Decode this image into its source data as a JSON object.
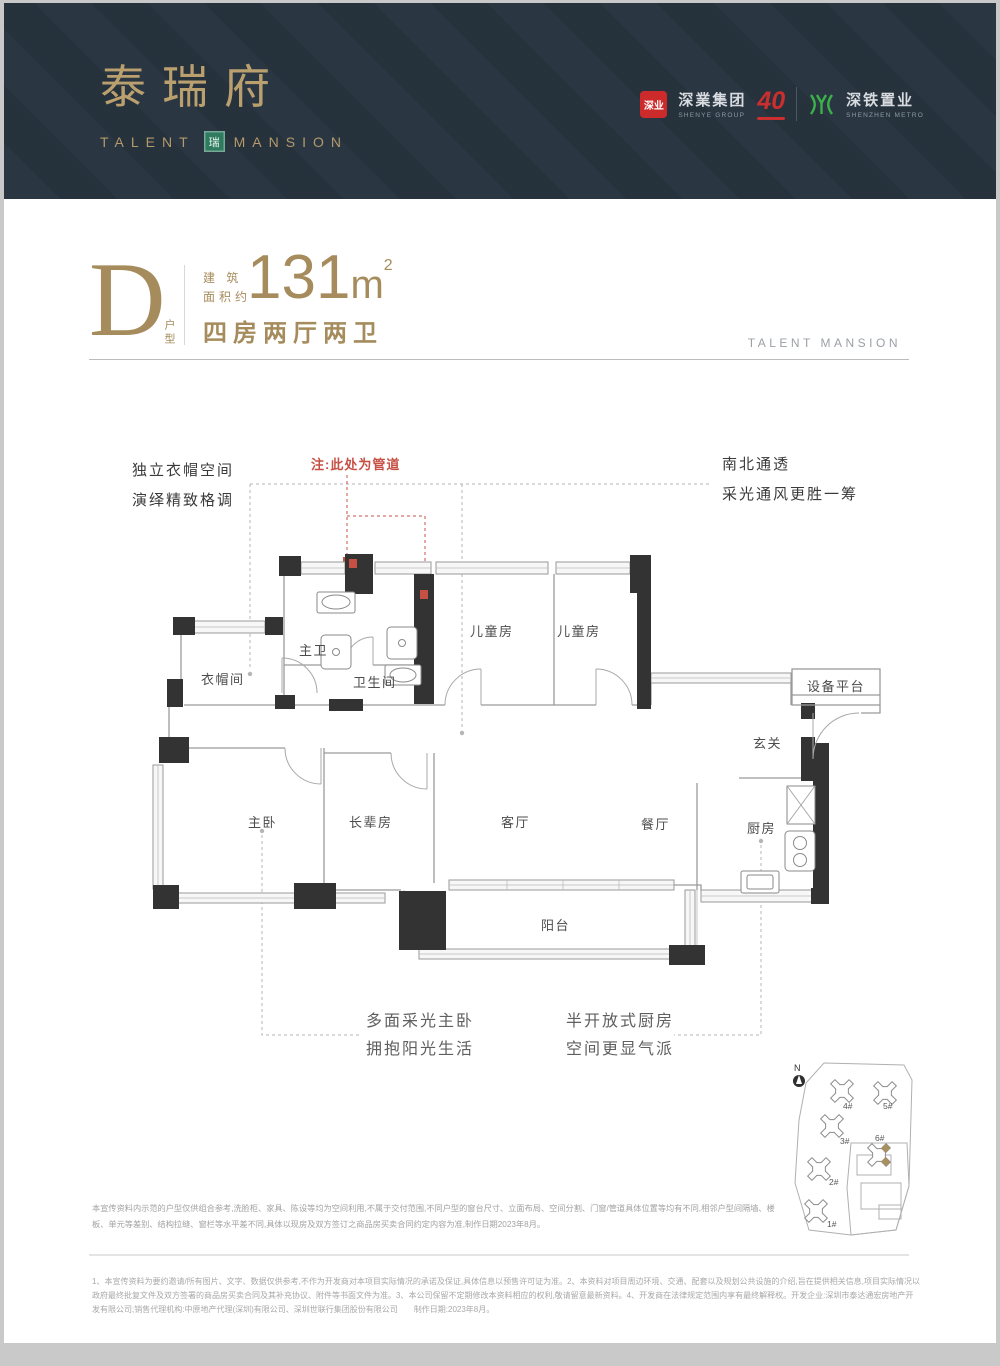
{
  "header": {
    "brand_cn": "泰瑞府",
    "brand_en_left": "TALENT",
    "brand_en_right": "MANSION",
    "seal_char": "瑞",
    "partners": {
      "shenye_badge": "深业",
      "shenye_cn": "深業集团",
      "shenye_en": "SHENYE GROUP",
      "anniversary": "40",
      "metro_cn": "深铁置业",
      "metro_en": "SHENZHEN METRO"
    }
  },
  "unit": {
    "type_letter": "D",
    "type_label": "户型",
    "area_prefix_l1": "建 筑",
    "area_prefix_l2": "面积约",
    "area_value": "131",
    "area_unit": "m",
    "area_sup": "2",
    "layout": "四房两厅两卫",
    "watermark": "TALENT MANSION"
  },
  "annotations": {
    "left_l1": "独立衣帽空间",
    "left_l2": "演绎精致格调",
    "pipe_note": "注:此处为管道",
    "right_l1": "南北通透",
    "right_l2": "采光通风更胜一筹",
    "bottom_left_l1": "多面采光主卧",
    "bottom_left_l2": "拥抱阳光生活",
    "bottom_right_l1": "半开放式厨房",
    "bottom_right_l2": "空间更显气派"
  },
  "floorplan": {
    "rooms": {
      "cloakroom": "衣帽间",
      "master_bath": "主卫",
      "bathroom": "卫生间",
      "kids_room_1": "儿童房",
      "kids_room_2": "儿童房",
      "equipment": "设备平台",
      "foyer": "玄关",
      "master_bedroom": "主卧",
      "elder_room": "长辈房",
      "living": "客厅",
      "dining": "餐厅",
      "kitchen": "厨房",
      "balcony": "阳台"
    }
  },
  "siteplan": {
    "north": "N",
    "buildings": [
      {
        "label": "1#"
      },
      {
        "label": "2#"
      },
      {
        "label": "3#"
      },
      {
        "label": "4#"
      },
      {
        "label": "5#"
      },
      {
        "label": "6#",
        "highlighted": true
      }
    ]
  },
  "disclaimers": {
    "block1": "本宣传资料内示范的户型仅供组合参考,洗脸柜、家具、陈设等均为空间利用,不属于交付范围,不同户型的窗台尺寸、立面布局、空间分割、门窗/管道具体位置等均有不同,相邻户型间隔墙、楼板、单元等差别、结构拉缝、窗栏等水平差不同,具体以现房及双方签订之商品房买卖合同约定内容为准,制作日期2023年8月。",
    "block2": "1、本宣传资料为要约邀请/所有图片、文字、数据仅供参考,不作为开发商对本项目实际情况的承诺及保证,具体信息以预售许可证为准。2、本资料对项目周边环境、交通、配套以及规划公共设施的介绍,旨在提供相关信息,项目实际情况以政府最终批复文件及双方签署的商品房买卖合同及其补充协议、附件等书面文件为准。3、本公司保留不定期修改本资料相应的权利,敬请留意最新资料。4、开发商在法律规定范围内享有最终解释权。开发企业:深圳市泰达通宏房地产开发有限公司;销售代理机构:中原地产代理(深圳)有限公司、深圳世联行集团股份有限公司　　制作日期:2023年8月。"
  },
  "colors": {
    "header_bg": "#27333e",
    "brand_gold": "#bba06f",
    "section_gold": "#a68c5d",
    "seal_green": "#2e7b60",
    "badge_red": "#cd2b2b",
    "metro_green": "#3cb14a",
    "annotation_red": "#c75045",
    "wall_black": "#333333"
  }
}
